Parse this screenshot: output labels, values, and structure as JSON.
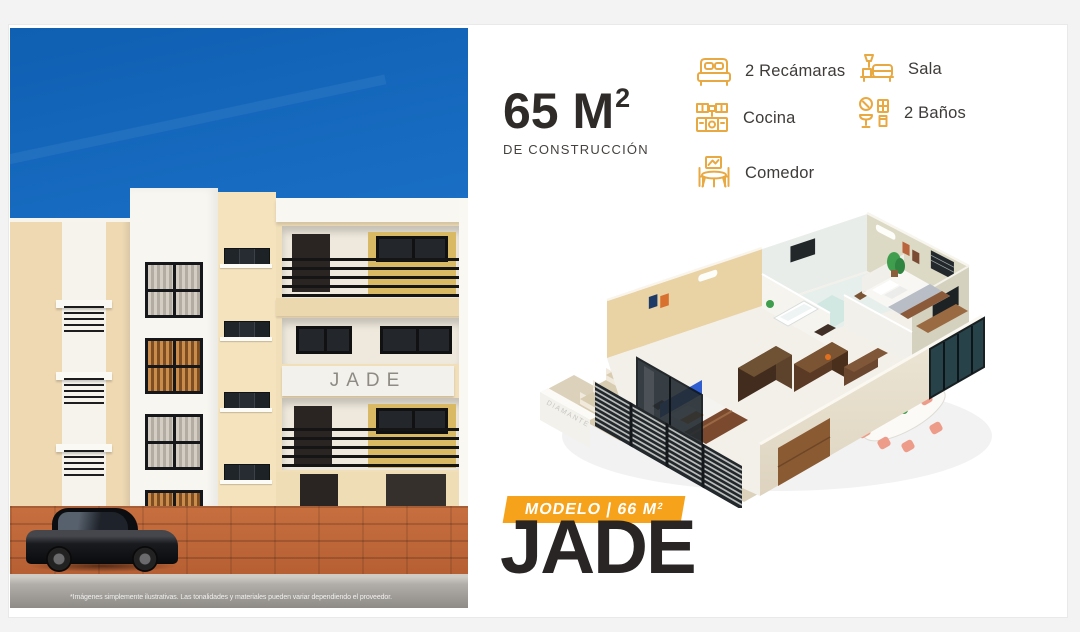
{
  "colors": {
    "accent_orange": "#F7A21B",
    "icon_amber": "#E9A942",
    "ink": "#2B2827",
    "sky_blue": "#1A70C6",
    "pavement_terracotta": "#C76F3F"
  },
  "photo": {
    "building_sign": "JADE",
    "disclaimer": "*Imágenes simplemente ilustrativas. Las tonalidades y materiales pueden variar dependiendo el proveedor."
  },
  "specs": {
    "area_value": "65 M",
    "area_sup": "2",
    "area_caption": "DE CONSTRUCCIÓN",
    "features": [
      {
        "icon": "bed-icon",
        "label": "2 Recámaras"
      },
      {
        "icon": "kitchen-icon",
        "label": "Cocina"
      },
      {
        "icon": "dining-icon",
        "label": "Comedor"
      },
      {
        "icon": "sofa-icon",
        "label": "Sala"
      },
      {
        "icon": "bath-icon",
        "label": "2 Baños"
      }
    ]
  },
  "model": {
    "badge_prefix": "MODELO | 66 M",
    "badge_sup": "2",
    "name": "JADE",
    "plan_sign": "DIAMANTE"
  }
}
